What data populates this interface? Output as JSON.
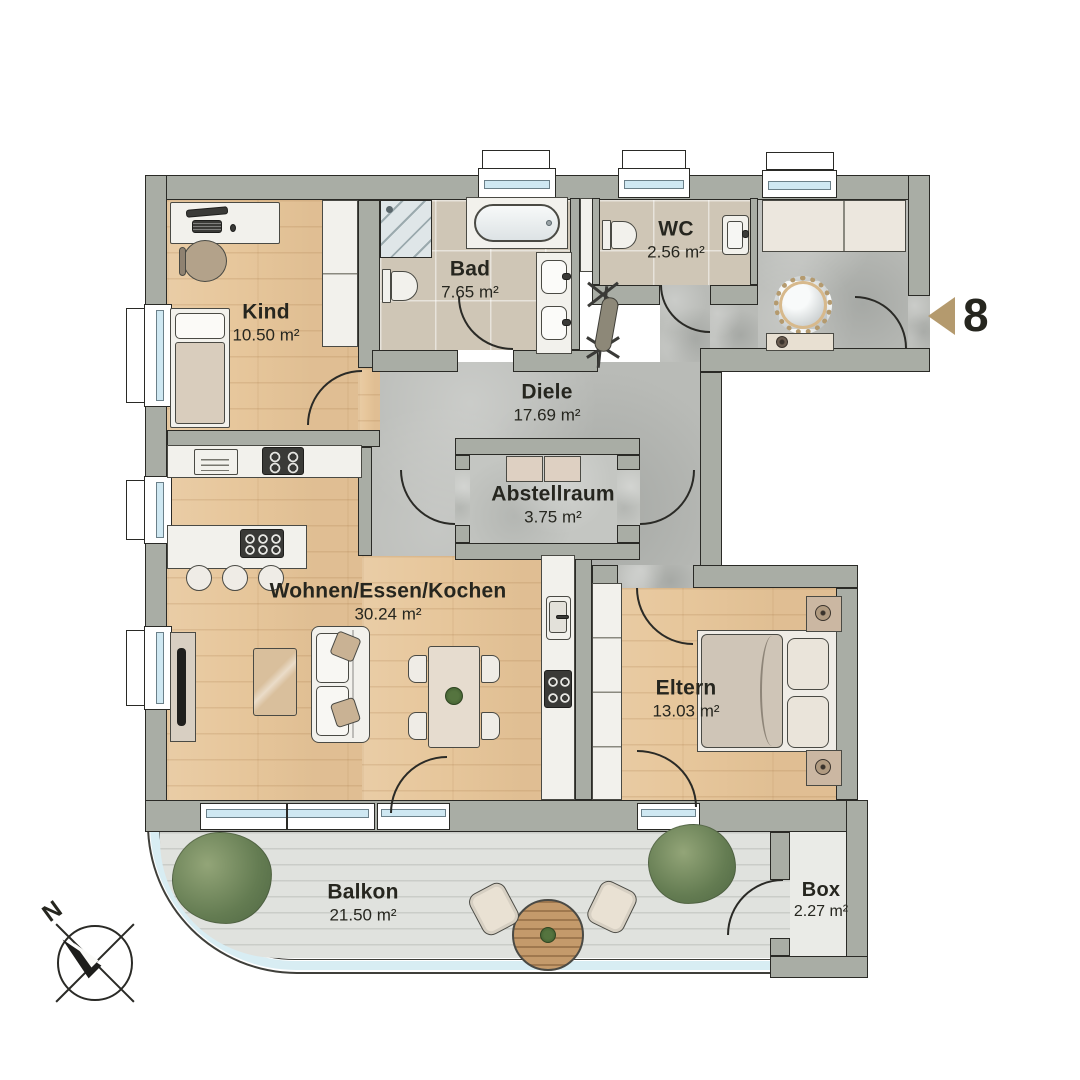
{
  "plan": {
    "unit_number": "8",
    "compass_label": "N",
    "rooms": {
      "kind": {
        "name": "Kind",
        "area": "10.50 m²"
      },
      "bad": {
        "name": "Bad",
        "area": "7.65 m²"
      },
      "wc": {
        "name": "WC",
        "area": "2.56 m²"
      },
      "diele": {
        "name": "Diele",
        "area": "17.69 m²"
      },
      "abstellraum": {
        "name": "Abstellraum",
        "area": "3.75 m²"
      },
      "wohnen_essen_kochen": {
        "name": "Wohnen/Essen/Kochen",
        "area": "30.24 m²"
      },
      "eltern": {
        "name": "Eltern",
        "area": "13.03 m²"
      },
      "balkon": {
        "name": "Balkon",
        "area": "21.50 m²"
      },
      "box": {
        "name": "Box",
        "area": "2.27 m²"
      }
    },
    "colors": {
      "wall": "#a9ada5",
      "wood": "#e7c79c",
      "tile": "#cfc6b6",
      "concrete": "#b9bbb7",
      "deck": "#e0e2de",
      "glass": "#cfe8f2",
      "accent": "#b49a6e"
    }
  }
}
